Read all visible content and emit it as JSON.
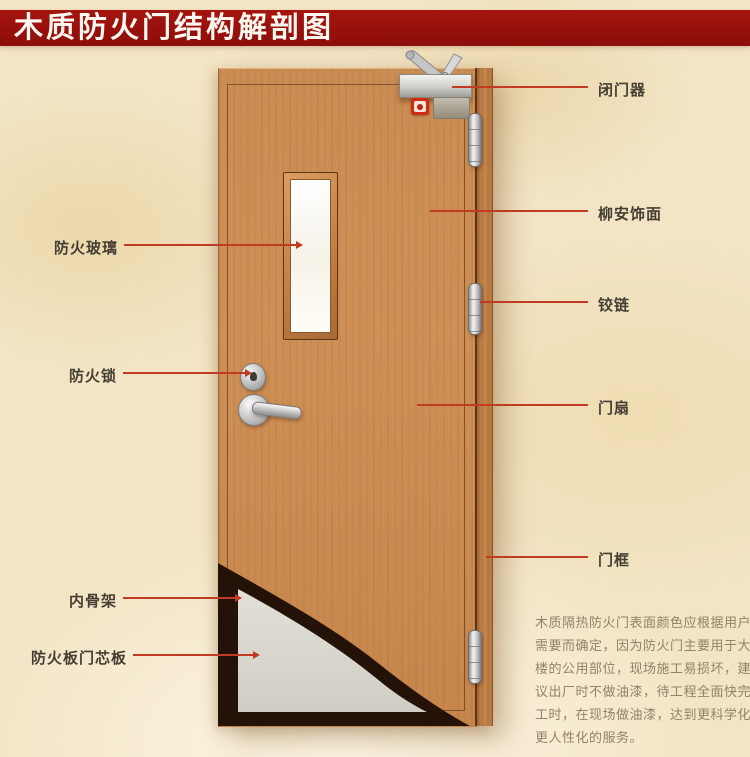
{
  "banner": {
    "title": "木质防火门结构解剖图"
  },
  "annotations": {
    "left": [
      {
        "label": "防火玻璃"
      },
      {
        "label": "防火锁"
      },
      {
        "label": "内骨架"
      },
      {
        "label": "防火板门芯板"
      }
    ],
    "right": [
      {
        "label": "闭门器"
      },
      {
        "label": "柳安饰面"
      },
      {
        "label": "铰链"
      },
      {
        "label": "门扇"
      },
      {
        "label": "门框"
      }
    ]
  },
  "description": {
    "text": "木质隔热防火门表面颜色应根据用户需要而确定，因为防火门主要用于大楼的公用部位，现场施工易损坏，建议出厂时不做油漆，待工程全面快完工时，在现场做油漆，达到更科学化更人性化的服务。"
  },
  "colors": {
    "banner_red": "#97100c",
    "callout_red": "#c13a24",
    "background_cream": "#f2e4c4",
    "wood": "#cb8c52",
    "core_gray": "#dbd9d1",
    "skeleton_dark": "#241209"
  }
}
